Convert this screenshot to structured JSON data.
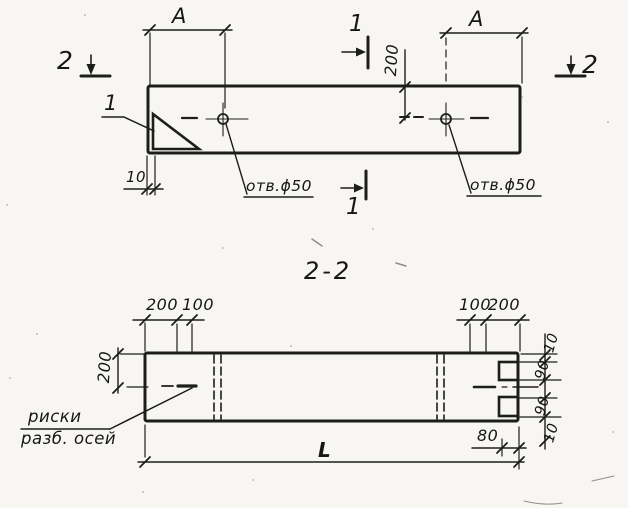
{
  "top_view": {
    "dim_a_left": "A",
    "dim_a_right": "A",
    "dim_200": "200",
    "dim_10": "10",
    "section_mark_1_top": "1",
    "section_mark_1_bottom": "1",
    "section_mark_2_left": "2",
    "section_mark_2_right": "2",
    "detail_callout": "1",
    "hole_label_left": "отв.ϕ50",
    "hole_label_right": "отв.ϕ50"
  },
  "section_view": {
    "title": "2-2",
    "dim_top_left_200": "200",
    "dim_top_left_100": "100",
    "dim_top_right_100": "100",
    "dim_top_right_200": "200",
    "dim_height_200": "200",
    "axes_note_line1": "риски",
    "axes_note_line2": "разб. осей",
    "dim_length": "L",
    "dim_80": "80",
    "dim_right_top_10": "10",
    "dim_right_upper_90": "90",
    "dim_right_lower_90": "90",
    "dim_right_bottom_10": "10"
  }
}
